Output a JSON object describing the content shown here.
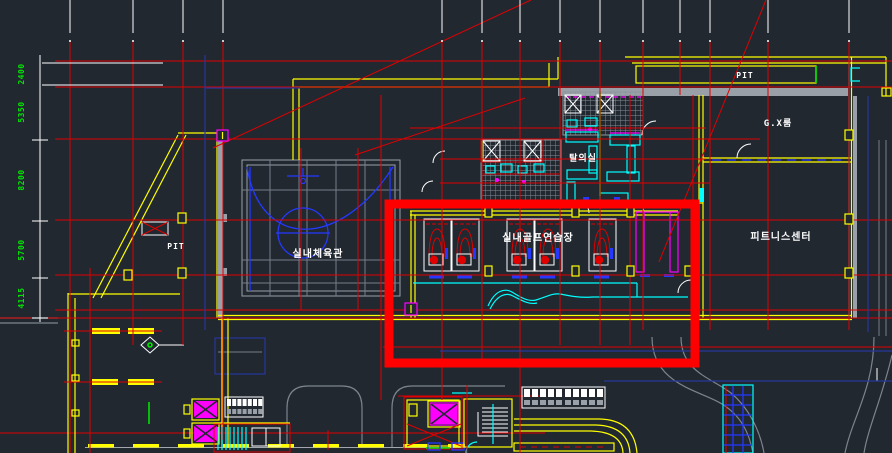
{
  "drawing": {
    "rooms": {
      "gym": "실내체육관",
      "golf_range": "실내골프연습장",
      "fitness_center": "피트니스센터",
      "gx_room": "G.X룸",
      "locker_room": "탈의실"
    },
    "annotations": {
      "pit_top": "PIT",
      "pit_left": "PIT"
    },
    "dimensions": [
      "2400",
      "5350",
      "8200",
      "5700",
      "4115"
    ],
    "colors": {
      "background": "#212830",
      "grid_red": "#e00000",
      "wall_yellow": "#ffff00",
      "fixture_cyan": "#00ffff",
      "elevator_magenta": "#ff00ff",
      "court_blue": "#2438ff",
      "dim_green": "#00e400",
      "concrete_gray": "#9aa0a8",
      "road_gray": "#7d848d",
      "highlight_red": "#ff0000",
      "text_white": "#ffffff",
      "navy": "#27379b"
    }
  }
}
